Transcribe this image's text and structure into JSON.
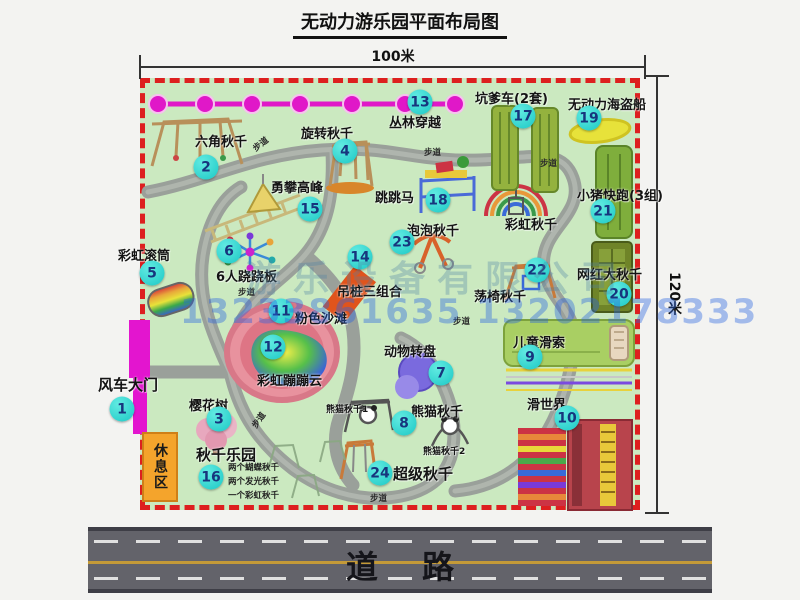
{
  "title": "无动力游乐园平面布局图",
  "dimensions": {
    "width_label": "100米",
    "height_label": "120米"
  },
  "road": {
    "label": "道路"
  },
  "watermark": {
    "company": "游乐设备有限公司",
    "phone": "13233861635 13202178333"
  },
  "park": {
    "path_label": "步道",
    "rest_area_label": "休息区",
    "rainbow_swing_label": "彩虹秋千",
    "panda_swing_1": "熊猫秋千1",
    "panda_swing_2": "熊猫秋千2",
    "swing_park_notes": [
      "两个蝴蝶秋千",
      "两个发光秋千",
      "一个彩虹秋千"
    ]
  },
  "attractions": [
    {
      "num": "1",
      "name": "风车大门"
    },
    {
      "num": "2",
      "name": "六角秋千"
    },
    {
      "num": "3",
      "name": "樱花树"
    },
    {
      "num": "4",
      "name": "旋转秋千"
    },
    {
      "num": "5",
      "name": "彩虹滚筒"
    },
    {
      "num": "6",
      "name": "6人跷跷板"
    },
    {
      "num": "7",
      "name": "动物转盘"
    },
    {
      "num": "8",
      "name": "熊猫秋千"
    },
    {
      "num": "9",
      "name": "儿童滑索"
    },
    {
      "num": "10",
      "name": "滑世界"
    },
    {
      "num": "11",
      "name": "粉色沙滩"
    },
    {
      "num": "12",
      "name": "彩虹蹦蹦云"
    },
    {
      "num": "13",
      "name": "丛林穿越"
    },
    {
      "num": "14",
      "name": "吊桩三组合"
    },
    {
      "num": "15",
      "name": "勇攀高峰"
    },
    {
      "num": "16",
      "name": "秋千乐园"
    },
    {
      "num": "17",
      "name": "坑爹车(2套)"
    },
    {
      "num": "18",
      "name": "跳跳马"
    },
    {
      "num": "19",
      "name": "无动力海盗船"
    },
    {
      "num": "20",
      "name": "网红大秋千"
    },
    {
      "num": "21",
      "name": "小猪快跑(3组)"
    },
    {
      "num": "22",
      "name": "荡椅秋千"
    },
    {
      "num": "23",
      "name": "泡泡秋千"
    },
    {
      "num": "24",
      "name": "超级秋千"
    }
  ]
}
